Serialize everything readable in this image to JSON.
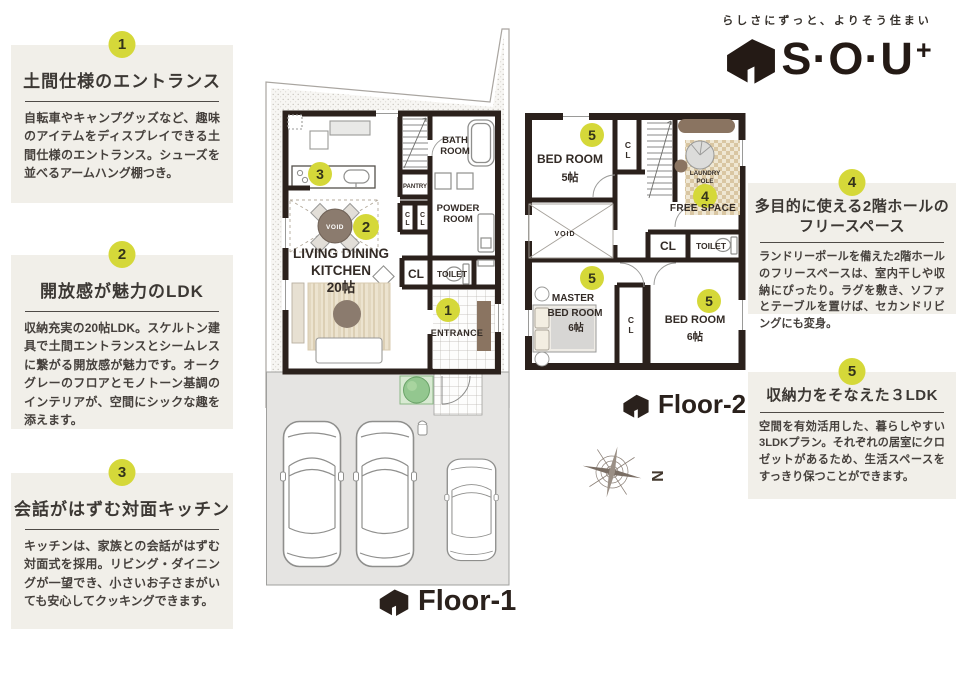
{
  "header": {
    "tagline": "らしさにずっと、よりそう住まい",
    "logo_text": "S·O·U",
    "logo_plus": "+"
  },
  "features": [
    {
      "num": "1",
      "title": "土間仕様のエントランス",
      "body": "自転車やキャンプグッズなど、趣味のアイテムをディスプレイできる土間仕様のエントランス。シューズを並べるアームハング棚つき。"
    },
    {
      "num": "2",
      "title": "開放感が魅力のLDK",
      "body": "収納充実の20帖LDK。スケルトン建具で土間エントランスとシームレスに繋がる開放感が魅力です。オークグレーのフロアとモノトーン基調のインテリアが、空間にシックな趣を添えます。"
    },
    {
      "num": "3",
      "title": "会話がはずむ対面キッチン",
      "body": "キッチンは、家族との会話がはずむ対面式を採用。リビング・ダイニングが一望でき、小さいお子さまがいても安心してクッキングできます。"
    },
    {
      "num": "4",
      "title": "多目的に使える2階ホールの",
      "title2": "フリースペース",
      "body": "ランドリーポールを備えた2階ホールのフリースペースは、室内干しや収納にぴったり。ラグを敷き、ソファとテーブルを置けば、セカンドリビングにも変身。"
    },
    {
      "num": "5",
      "title": "収納力をそなえた３LDK",
      "body": "空間を有効活用した、暮らしやすい3LDKプラン。それぞれの居室にクロゼットがあるため、生活スペースをすっきり保つことができます。"
    }
  ],
  "floor1": {
    "label": "Floor-1",
    "bath": [
      "BATH",
      "ROOM"
    ],
    "pantry": "PANTRY",
    "powder": [
      "POWDER",
      "ROOM"
    ],
    "cl_small": [
      "C",
      "L"
    ],
    "cl": "CL",
    "toilet": "TOILET",
    "entrance": "ENTRANCE",
    "ldk": [
      "LIVING DINING",
      "KITCHEN",
      "20帖"
    ],
    "void": "VOID"
  },
  "floor2": {
    "label": "Floor-2",
    "bed5": [
      "BED ROOM",
      "5帖"
    ],
    "cl_small": [
      "C",
      "L"
    ],
    "laundry": [
      "LAUNDRY",
      "POLE"
    ],
    "free_space": "FREE SPACE",
    "void": "VOID",
    "cl": "CL",
    "toilet": "TOILET",
    "master": [
      "MASTER",
      "BED ROOM",
      "6帖"
    ],
    "bed6": [
      "BED ROOM",
      "6帖"
    ],
    "compass_n": "N"
  }
}
